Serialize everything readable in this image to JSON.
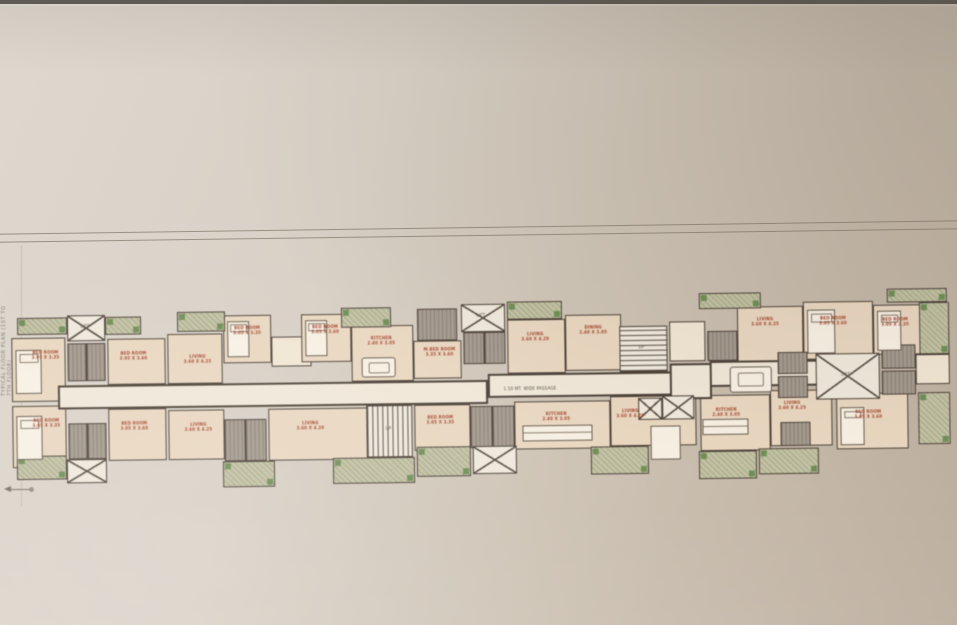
{
  "photo": {
    "background_light": "#ded8cf",
    "background_dark": "#bcae9e",
    "top_strip_color": "#5f5c55",
    "sheet_line_color": "#8a8073"
  },
  "palette": {
    "wall": "#4e4339",
    "room_fill": "#ead7bf",
    "room_light_fill": "#f2e6d2",
    "corridor_fill": "#f0e7d7",
    "toilet_fill": "#a59a8d",
    "balcony_fill": "#c3c2a2",
    "balcony_green": "#6f8f55",
    "label_red": "#a8462e",
    "label_dark": "#4e463c"
  },
  "edge_note": "TYPICAL FLOOR PLAN (1ST TO 7TH FLOOR)",
  "plan": {
    "blocks": [
      {
        "t": "rm",
        "x": 2,
        "y": 38,
        "w": 54,
        "h": 64
      },
      {
        "t": "rm",
        "x": 98,
        "y": 40,
        "w": 58,
        "h": 46
      },
      {
        "t": "rm",
        "x": 158,
        "y": 36,
        "w": 55,
        "h": 50
      },
      {
        "t": "rm",
        "x": 214,
        "y": 18,
        "w": 48,
        "h": 48
      },
      {
        "t": "rml",
        "x": 262,
        "y": 40,
        "w": 40,
        "h": 30
      },
      {
        "t": "rm",
        "x": 292,
        "y": 18,
        "w": 50,
        "h": 48
      },
      {
        "t": "rm",
        "x": 342,
        "y": 30,
        "w": 62,
        "h": 56
      },
      {
        "t": "rm",
        "x": 404,
        "y": 46,
        "w": 48,
        "h": 38
      },
      {
        "t": "rm",
        "x": 498,
        "y": 26,
        "w": 58,
        "h": 54
      },
      {
        "t": "rm",
        "x": 556,
        "y": 22,
        "w": 56,
        "h": 56
      },
      {
        "t": "rml",
        "x": 660,
        "y": 30,
        "w": 36,
        "h": 40
      },
      {
        "t": "rm",
        "x": 728,
        "y": 16,
        "w": 66,
        "h": 56
      },
      {
        "t": "rm",
        "x": 794,
        "y": 12,
        "w": 70,
        "h": 58
      },
      {
        "t": "rm",
        "x": 864,
        "y": 16,
        "w": 48,
        "h": 50
      },
      {
        "t": "rm",
        "x": 2,
        "y": 106,
        "w": 54,
        "h": 62
      },
      {
        "t": "rm",
        "x": 98,
        "y": 110,
        "w": 58,
        "h": 52
      },
      {
        "t": "rm",
        "x": 158,
        "y": 112,
        "w": 56,
        "h": 50
      },
      {
        "t": "rm",
        "x": 258,
        "y": 112,
        "w": 100,
        "h": 52
      },
      {
        "t": "rm",
        "x": 404,
        "y": 110,
        "w": 56,
        "h": 46
      },
      {
        "t": "rm",
        "x": 504,
        "y": 108,
        "w": 96,
        "h": 48
      },
      {
        "t": "rm",
        "x": 600,
        "y": 104,
        "w": 86,
        "h": 50
      },
      {
        "t": "rm",
        "x": 690,
        "y": 104,
        "w": 70,
        "h": 56
      },
      {
        "t": "rm",
        "x": 760,
        "y": 100,
        "w": 62,
        "h": 56
      },
      {
        "t": "rm",
        "x": 826,
        "y": 104,
        "w": 72,
        "h": 56
      },
      {
        "t": "rml",
        "x": 906,
        "y": 66,
        "w": 34,
        "h": 30
      },
      {
        "t": "corr",
        "x": 48,
        "y": 86,
        "w": 430,
        "h": 24
      },
      {
        "t": "corr",
        "x": 478,
        "y": 80,
        "w": 184,
        "h": 24
      },
      {
        "t": "corr",
        "x": 660,
        "y": 72,
        "w": 42,
        "h": 36
      },
      {
        "t": "corr",
        "x": 700,
        "y": 70,
        "w": 132,
        "h": 26
      },
      {
        "t": "balc",
        "x": 8,
        "y": 18,
        "w": 50,
        "h": 17
      },
      {
        "t": "x",
        "x": 58,
        "y": 16,
        "w": 38,
        "h": 26
      },
      {
        "t": "balc",
        "x": 96,
        "y": 18,
        "w": 36,
        "h": 18
      },
      {
        "t": "balc",
        "x": 168,
        "y": 14,
        "w": 48,
        "h": 20
      },
      {
        "t": "balc",
        "x": 332,
        "y": 12,
        "w": 50,
        "h": 20
      },
      {
        "t": "wc",
        "x": 408,
        "y": 14,
        "w": 40,
        "h": 32
      },
      {
        "t": "x",
        "x": 452,
        "y": 10,
        "w": 44,
        "h": 28
      },
      {
        "t": "balc",
        "x": 498,
        "y": 8,
        "w": 55,
        "h": 18
      },
      {
        "t": "balc",
        "x": 690,
        "y": 2,
        "w": 62,
        "h": 16
      },
      {
        "t": "balc",
        "x": 878,
        "y": 0,
        "w": 60,
        "h": 14
      },
      {
        "t": "wc",
        "x": 58,
        "y": 44,
        "w": 19,
        "h": 38
      },
      {
        "t": "wc",
        "x": 77,
        "y": 44,
        "w": 19,
        "h": 38
      },
      {
        "t": "wc",
        "x": 454,
        "y": 38,
        "w": 21,
        "h": 32
      },
      {
        "t": "wc",
        "x": 475,
        "y": 38,
        "w": 21,
        "h": 32
      },
      {
        "t": "sh",
        "x": 610,
        "y": 34,
        "w": 48,
        "h": 46
      },
      {
        "t": "wc",
        "x": 698,
        "y": 40,
        "w": 30,
        "h": 30
      },
      {
        "t": "balc",
        "x": 910,
        "y": 14,
        "w": 30,
        "h": 52
      },
      {
        "t": "tbl",
        "x": 720,
        "y": 76,
        "w": 42,
        "h": 26
      },
      {
        "t": "wc",
        "x": 768,
        "y": 62,
        "w": 30,
        "h": 22
      },
      {
        "t": "wc",
        "x": 768,
        "y": 86,
        "w": 30,
        "h": 22
      },
      {
        "t": "x",
        "x": 806,
        "y": 64,
        "w": 64,
        "h": 46
      },
      {
        "t": "wc",
        "x": 872,
        "y": 56,
        "w": 34,
        "h": 24
      },
      {
        "t": "wc",
        "x": 872,
        "y": 82,
        "w": 34,
        "h": 24
      },
      {
        "t": "wc",
        "x": 58,
        "y": 124,
        "w": 19,
        "h": 36
      },
      {
        "t": "wc",
        "x": 77,
        "y": 124,
        "w": 19,
        "h": 36
      },
      {
        "t": "x",
        "x": 56,
        "y": 160,
        "w": 40,
        "h": 24
      },
      {
        "t": "balc",
        "x": 6,
        "y": 156,
        "w": 50,
        "h": 24
      },
      {
        "t": "wc",
        "x": 214,
        "y": 122,
        "w": 21,
        "h": 42
      },
      {
        "t": "wc",
        "x": 235,
        "y": 122,
        "w": 21,
        "h": 42
      },
      {
        "t": "balc",
        "x": 212,
        "y": 164,
        "w": 52,
        "h": 26
      },
      {
        "t": "sv",
        "x": 356,
        "y": 110,
        "w": 46,
        "h": 52
      },
      {
        "t": "balc",
        "x": 322,
        "y": 162,
        "w": 82,
        "h": 26
      },
      {
        "t": "wc",
        "x": 460,
        "y": 112,
        "w": 22,
        "h": 42
      },
      {
        "t": "wc",
        "x": 482,
        "y": 112,
        "w": 22,
        "h": 42
      },
      {
        "t": "x",
        "x": 462,
        "y": 152,
        "w": 44,
        "h": 28
      },
      {
        "t": "balc",
        "x": 406,
        "y": 152,
        "w": 54,
        "h": 30
      },
      {
        "t": "cnt",
        "x": 512,
        "y": 132,
        "w": 70,
        "h": 16
      },
      {
        "t": "balc",
        "x": 580,
        "y": 154,
        "w": 58,
        "h": 28
      },
      {
        "t": "x",
        "x": 628,
        "y": 106,
        "w": 24,
        "h": 22
      },
      {
        "t": "x",
        "x": 652,
        "y": 104,
        "w": 32,
        "h": 24
      },
      {
        "t": "wht",
        "x": 640,
        "y": 134,
        "w": 30,
        "h": 34
      },
      {
        "t": "cnt",
        "x": 692,
        "y": 128,
        "w": 46,
        "h": 16
      },
      {
        "t": "balc",
        "x": 688,
        "y": 160,
        "w": 58,
        "h": 28
      },
      {
        "t": "wc",
        "x": 770,
        "y": 132,
        "w": 30,
        "h": 24
      },
      {
        "t": "balc",
        "x": 748,
        "y": 158,
        "w": 60,
        "h": 26
      },
      {
        "t": "balc",
        "x": 908,
        "y": 104,
        "w": 32,
        "h": 52
      },
      {
        "t": "bed",
        "x": 6,
        "y": 50,
        "w": 26,
        "h": 44
      },
      {
        "t": "bed",
        "x": 6,
        "y": 116,
        "w": 26,
        "h": 44
      },
      {
        "t": "bed",
        "x": 218,
        "y": 24,
        "w": 22,
        "h": 36
      },
      {
        "t": "bed",
        "x": 296,
        "y": 24,
        "w": 22,
        "h": 36
      },
      {
        "t": "bed",
        "x": 798,
        "y": 20,
        "w": 28,
        "h": 44
      },
      {
        "t": "bed",
        "x": 868,
        "y": 22,
        "w": 24,
        "h": 40
      },
      {
        "t": "bed",
        "x": 830,
        "y": 118,
        "w": 24,
        "h": 38
      },
      {
        "t": "tbl",
        "x": 352,
        "y": 62,
        "w": 34,
        "h": 20
      }
    ],
    "labels": [
      {
        "x": 36,
        "y": 56,
        "c": "r",
        "text": "BED ROOM\n3.05 X 3.35"
      },
      {
        "x": 124,
        "y": 58,
        "c": "r",
        "text": "BED ROOM\n3.05 X 3.60"
      },
      {
        "x": 188,
        "y": 62,
        "c": "r",
        "text": "LIVING\n3.60 X 4.25"
      },
      {
        "x": 238,
        "y": 34,
        "c": "r",
        "text": "BED ROOM\n3.05 X 3.35"
      },
      {
        "x": 316,
        "y": 34,
        "c": "r",
        "text": "BED ROOM\n3.05 X 3.60"
      },
      {
        "x": 372,
        "y": 46,
        "c": "r",
        "text": "KITCHEN\n2.40 X 3.05"
      },
      {
        "x": 430,
        "y": 58,
        "c": "r",
        "text": "M.BED ROOM\n3.35 X 3.60"
      },
      {
        "x": 526,
        "y": 44,
        "c": "r",
        "text": "LIVING\n3.60 X 4.20"
      },
      {
        "x": 584,
        "y": 38,
        "c": "r",
        "text": "DINING\n2.40 X 3.05"
      },
      {
        "x": 756,
        "y": 32,
        "c": "r",
        "text": "LIVING\n3.60 X 4.25"
      },
      {
        "x": 824,
        "y": 32,
        "c": "r",
        "text": "BED ROOM\n3.05 X 3.60"
      },
      {
        "x": 886,
        "y": 34,
        "c": "r",
        "text": "BED ROOM\n3.05 X 3.35"
      },
      {
        "x": 36,
        "y": 124,
        "c": "r",
        "text": "BED ROOM\n3.05 X 3.35"
      },
      {
        "x": 124,
        "y": 128,
        "c": "r",
        "text": "BED ROOM\n3.05 X 3.60"
      },
      {
        "x": 188,
        "y": 130,
        "c": "r",
        "text": "LIVING\n3.60 X 4.25"
      },
      {
        "x": 300,
        "y": 130,
        "c": "r",
        "text": "LIVING\n3.60 X 4.20"
      },
      {
        "x": 430,
        "y": 126,
        "c": "r",
        "text": "BED ROOM\n3.05 X 3.35"
      },
      {
        "x": 546,
        "y": 124,
        "c": "r",
        "text": "KITCHEN\n2.40 X 3.05"
      },
      {
        "x": 620,
        "y": 122,
        "c": "r",
        "text": "LIVING\n3.60 X 4.20"
      },
      {
        "x": 716,
        "y": 122,
        "c": "r",
        "text": "KITCHEN\n2.40 X 3.05"
      },
      {
        "x": 782,
        "y": 116,
        "c": "r",
        "text": "LIVING\n3.60 X 4.25"
      },
      {
        "x": 858,
        "y": 126,
        "c": "r",
        "text": "BED ROOM\n3.05 X 3.60"
      },
      {
        "x": 520,
        "y": 96,
        "c": "d",
        "text": "1.50 MT. WIDE PASSAGE"
      },
      {
        "x": 76,
        "y": 28,
        "c": "d",
        "text": "LIFT"
      },
      {
        "x": 472,
        "y": 22,
        "c": "d",
        "text": "LIFT"
      },
      {
        "x": 836,
        "y": 86,
        "c": "d",
        "text": "LIFT"
      },
      {
        "x": 378,
        "y": 134,
        "c": "d",
        "text": "UP"
      },
      {
        "x": 632,
        "y": 56,
        "c": "d",
        "text": "UP"
      }
    ]
  }
}
